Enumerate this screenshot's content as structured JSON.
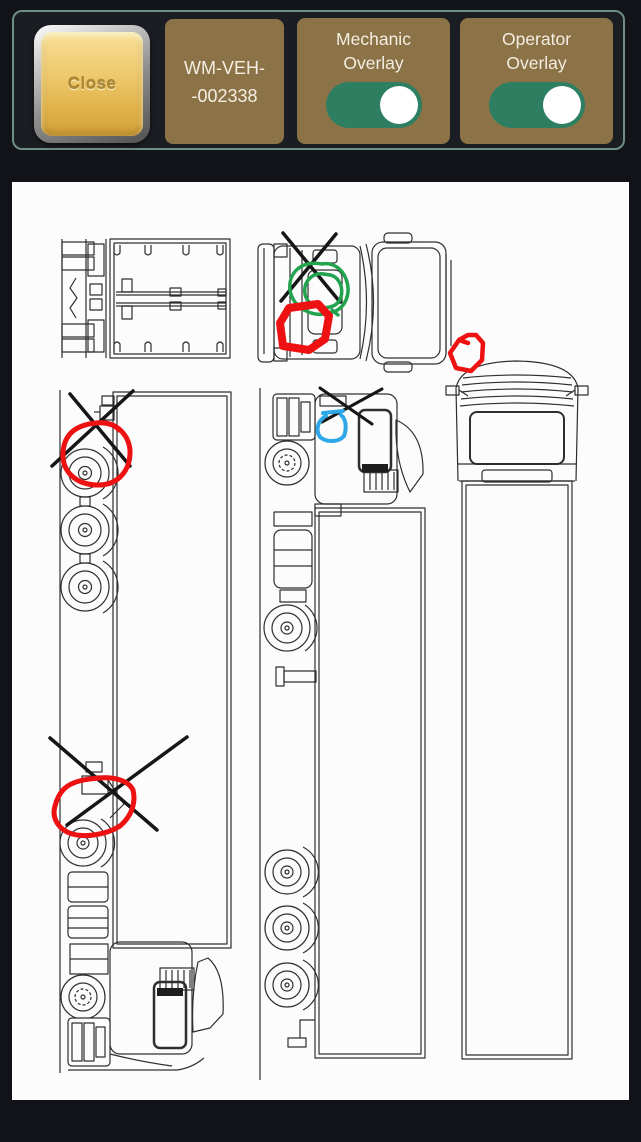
{
  "header": {
    "close_button": "Close",
    "vehicle_id": {
      "line1": "WM-VEH-",
      "line2": "-002338"
    },
    "toggles": [
      {
        "id": "mechanic-overlay",
        "label_line1": "Mechanic",
        "label_line2": "Overlay",
        "state": "on"
      },
      {
        "id": "operator-overlay",
        "label_line1": "Operator",
        "label_line2": "Overlay",
        "state": "on"
      }
    ]
  },
  "colors": {
    "panel_brown": "#8b7347",
    "toggle_on_green": "#2e7e62",
    "gold_button": "#eec566",
    "annotation_red": "#ee1111",
    "annotation_green": "#22a34e",
    "annotation_blue": "#2ea7e6",
    "annotation_black": "#161616",
    "canvas_white": "#fcfcfc",
    "background_dark": "#111318"
  },
  "canvas": {
    "views": [
      "trailer-top-view",
      "tractor-top-view",
      "truck-left-side-view",
      "truck-right-side-view",
      "truck-front-view"
    ],
    "annotations": [
      {
        "id": "black-x-tractor-top",
        "view": "tractor-top-view",
        "color": "#161616",
        "width": 3.5,
        "paths": [
          "M271,51 L328,120",
          "M324,52 L269,119"
        ]
      },
      {
        "id": "green-scribble-tractor-top",
        "view": "tractor-top-view",
        "color": "#22a34e",
        "width": 3.5,
        "paths": [
          "M310,82 C288,78 276,92 278,108 C281,126 300,136 318,131 C335,127 339,110 334,97 C330,86 320,80 310,82 Z",
          "M312,92 C300,90 291,100 293,112 C295,123 309,129 321,124 C331,120 332,106 326,98 C321,92 316,93 312,92 Z",
          "M320,128 l6,5"
        ]
      },
      {
        "id": "red-outline-tractor-top",
        "view": "tractor-top-view",
        "color": "#ee1111",
        "width": 8,
        "paths": [
          "M268,141 L277,126 L306,122 L317,134 L313,157 L297,168 L271,164 Z"
        ]
      },
      {
        "id": "black-x-left-rear-wheel",
        "view": "truck-left-side-view",
        "color": "#161616",
        "width": 3.5,
        "paths": [
          "M58,212 L118,284",
          "M121,209 L40,284"
        ]
      },
      {
        "id": "red-circle-left-rear-wheel",
        "view": "truck-left-side-view",
        "color": "#ee1111",
        "width": 5,
        "paths": [
          "M84,241 C104,238 119,254 118,272 C117,291 104,304 84,303 C64,302 50,290 51,271 C52,252 64,243 84,241 C95,240 103,243 107,248"
        ]
      },
      {
        "id": "black-x-left-fifth-wheel",
        "view": "truck-left-side-view",
        "color": "#161616",
        "width": 3.5,
        "paths": [
          "M38,556 L145,648",
          "M175,555 L55,643"
        ]
      },
      {
        "id": "red-outline-left-fifth-wheel",
        "view": "truck-left-side-view",
        "color": "#ee1111",
        "width": 5,
        "paths": [
          "M52,607 C60,599 74,597 88,596 C102,595 116,598 121,608 C124,620 120,634 108,644 C94,653 70,657 55,650 C44,644 40,634 43,624 C45,616 48,611 52,607 Z"
        ]
      },
      {
        "id": "black-x-right-cab",
        "view": "truck-right-side-view",
        "color": "#161616",
        "width": 3,
        "paths": [
          "M308,206 L360,242",
          "M370,207 L310,240"
        ]
      },
      {
        "id": "blue-outline-right-cab",
        "view": "truck-right-side-view",
        "color": "#2ea7e6",
        "width": 4,
        "paths": [
          "M311,231 L331,229",
          "M314,234 C306,238 303,248 308,255 C315,261 327,260 332,254 C335,246 334,237 329,233"
        ]
      },
      {
        "id": "red-scribble-front-roof",
        "view": "truck-front-view",
        "color": "#ee1111",
        "width": 4.5,
        "paths": [
          "M447,158 L456,153 L464,153 L471,161 L470,178 L459,189 L444,186 L438,171 L447,158 L456,161"
        ]
      }
    ]
  }
}
